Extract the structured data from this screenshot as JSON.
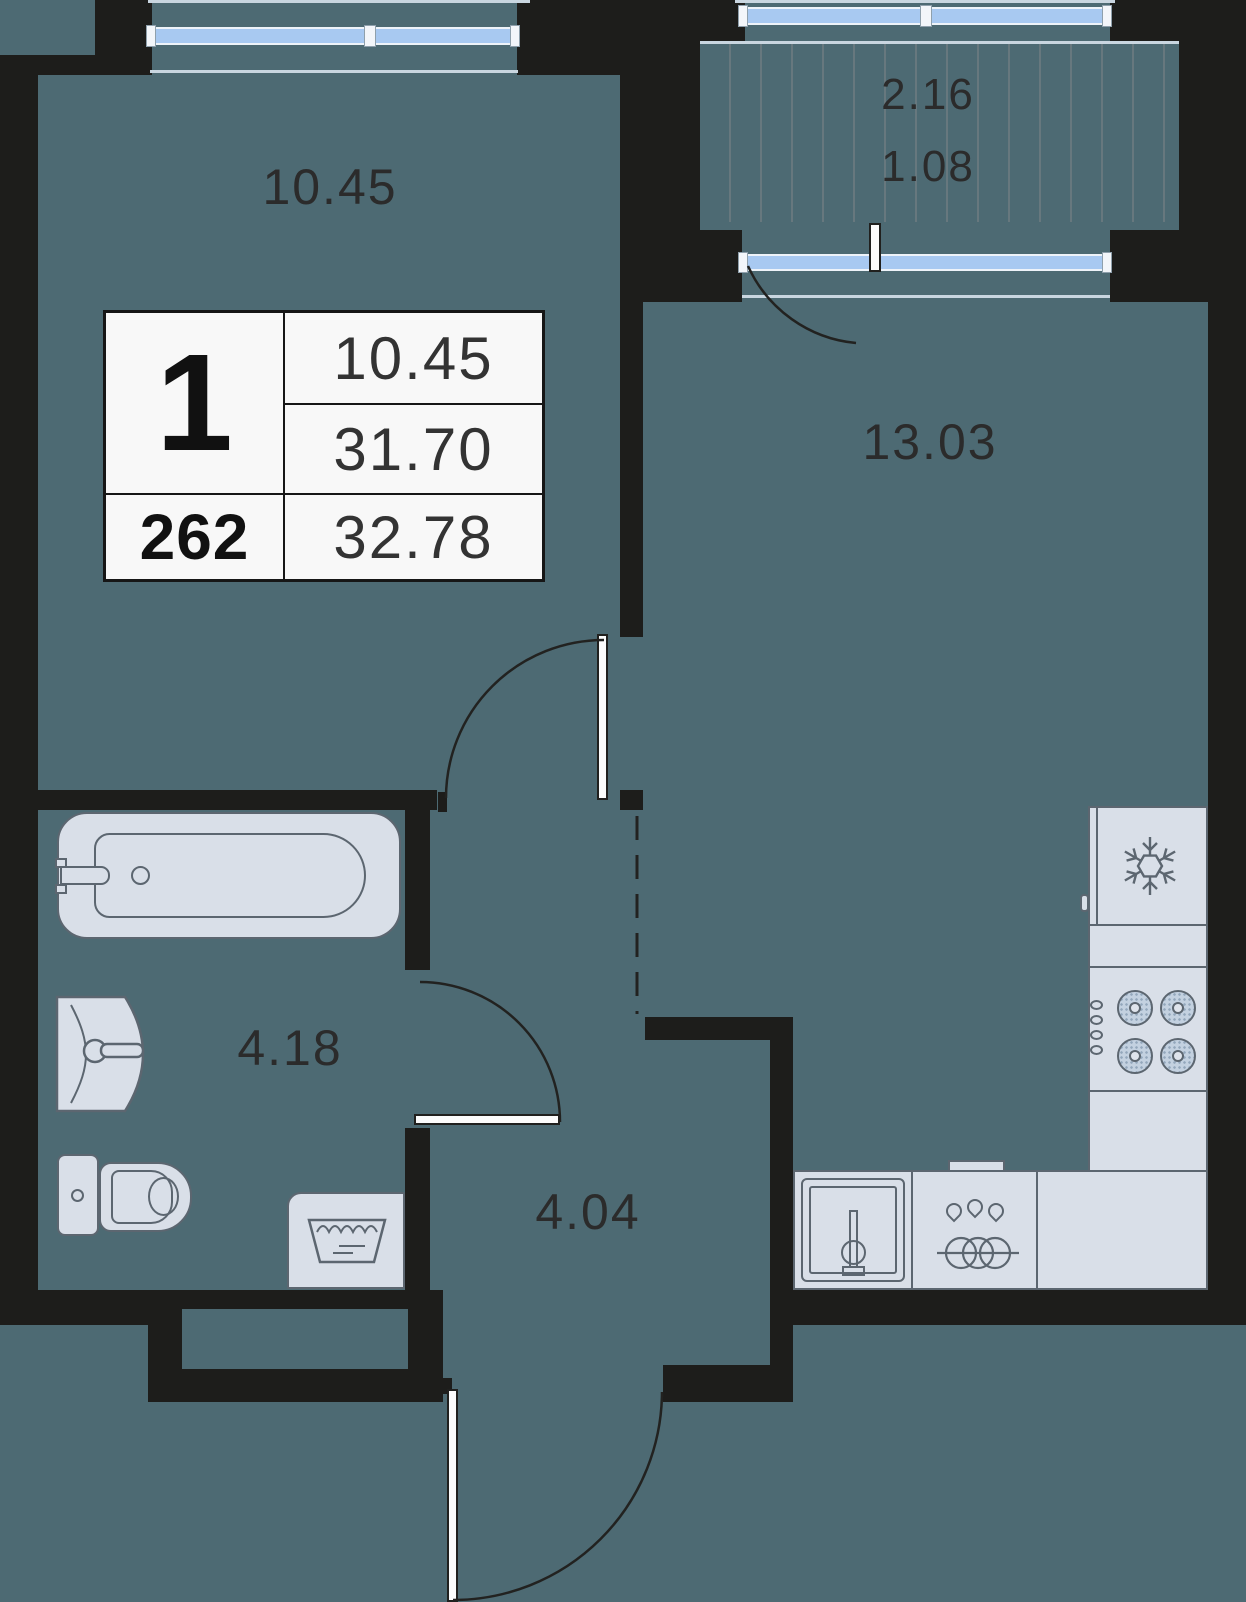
{
  "rooms": {
    "living": "10.45",
    "kitchen_living": "13.03",
    "bathroom": "4.18",
    "hallway": "4.04",
    "balcony_full": "2.16",
    "balcony_reduced": "1.08"
  },
  "info_table": {
    "rooms_count": "1",
    "unit_number": "262",
    "living_area": "10.45",
    "area_no_balcony": "31.70",
    "total_area": "32.78"
  },
  "colors": {
    "background": "#4d6a73",
    "walls": "#1d1d1b",
    "glazing": "#a8c9f1",
    "fixtures": "#d9dfe8",
    "fixture_outline": "#5c6670",
    "table_bg": "#f8f8f8",
    "text": "#2b2b2b"
  },
  "icons": {
    "fridge": "snowflake-icon",
    "stove": "burner-ring-icons",
    "washer": "laundry-tub-icon",
    "kitchen_cabinet": "water-drops-and-plates-icons"
  }
}
